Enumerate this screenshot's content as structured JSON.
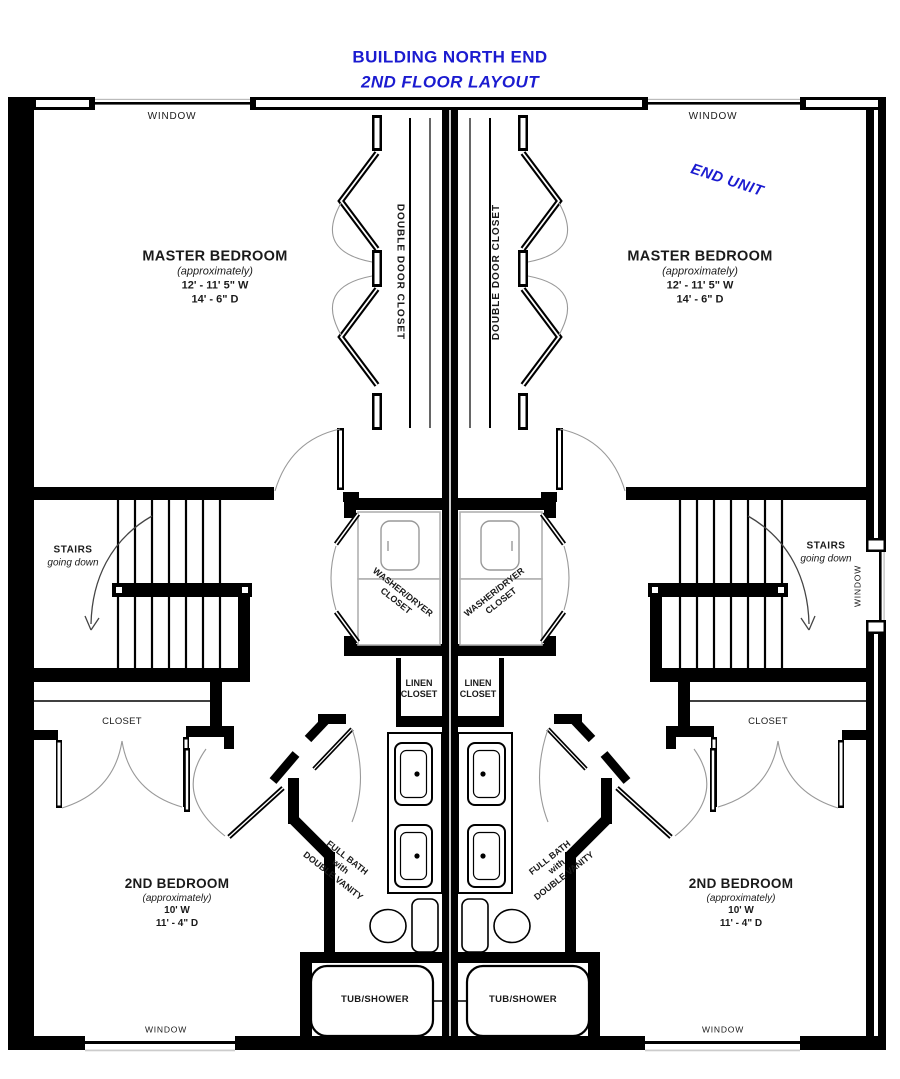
{
  "title": {
    "line1": "BUILDING NORTH END",
    "line2": "2ND FLOOR LAYOUT"
  },
  "annotations": {
    "end_unit": "END UNIT"
  },
  "labels": {
    "window": "WINDOW",
    "double_door_closet": "DOUBLE DOOR CLOSET",
    "stairs": {
      "line1": "STAIRS",
      "line2": "going down"
    },
    "washer_dryer": {
      "line1": "WASHER/DRYER",
      "line2": "CLOSET"
    },
    "linen": {
      "line1": "LINEN",
      "line2": "CLOSET"
    },
    "closet": "CLOSET",
    "full_bath": {
      "line1": "FULL BATH",
      "line2": "with",
      "line3": "DOUBLE VANITY"
    },
    "tub_shower": "TUB/SHOWER"
  },
  "rooms": {
    "master_bedroom": {
      "name": "MASTER BEDROOM",
      "approx": "(approximately)",
      "width": "12' - 11' 5\" W",
      "depth": "14' - 6\" D"
    },
    "second_bedroom": {
      "name": "2ND BEDROOM",
      "approx": "(approximately)",
      "width": "10' W",
      "depth": "11' - 4\" D"
    }
  },
  "colors": {
    "accent_blue": "#1b1bd0",
    "wall_black": "#000000",
    "appliance_gray": "#b0b0b0",
    "arc_gray": "#999999"
  }
}
